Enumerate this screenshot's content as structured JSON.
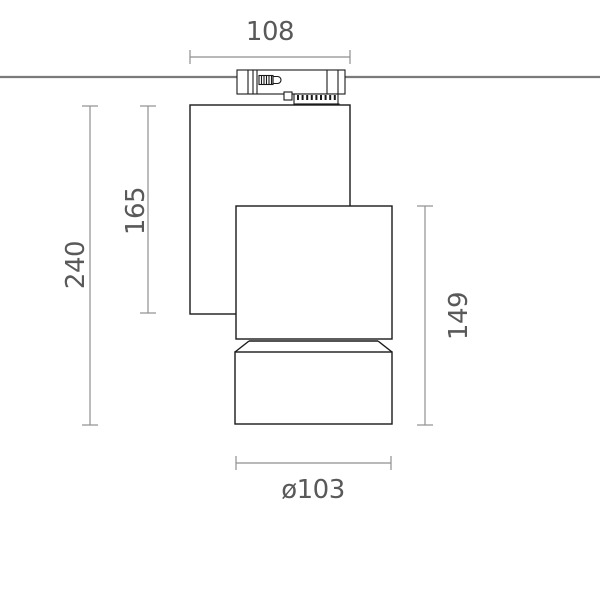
{
  "diagram": {
    "type": "technical-dimension-drawing",
    "subject": "track-mounted-spotlight-side-view",
    "dimensions": {
      "top_width": "108",
      "overall_height": "240",
      "body_height": "165",
      "head_height": "149",
      "bottom_diameter": "ø103"
    },
    "colors": {
      "fixture_outline": "#1a1a1a",
      "dimension_lines": "#8f8f8f",
      "dimension_text": "#595959",
      "ceiling_line": "#7a7a7a",
      "background": "#ffffff"
    }
  }
}
